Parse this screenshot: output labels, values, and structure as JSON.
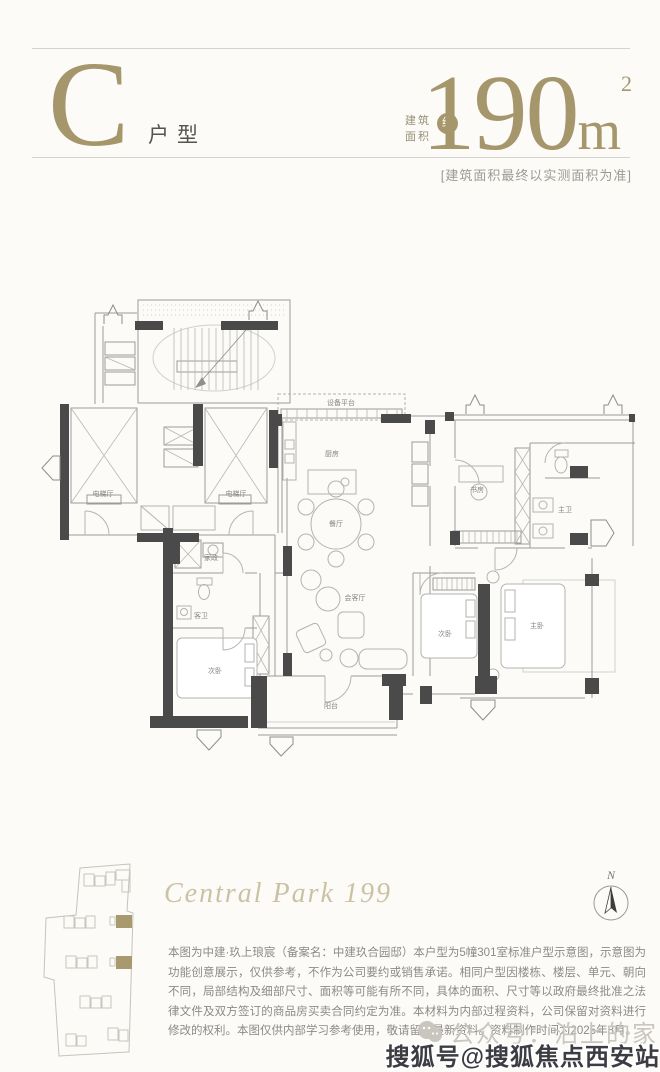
{
  "colors": {
    "accent": "#a5976b",
    "wall": "#4a4a4a",
    "text_gray": "#8b8b86"
  },
  "header": {
    "unit_letter": "C",
    "unit_type_label": "户型",
    "area_label_top": "建筑",
    "area_label_bottom": "面积",
    "area_approx": "约",
    "area_value": "190",
    "area_unit": "m",
    "area_unit_sup": "2",
    "area_note": "[建筑面积最终以实测面积为准]"
  },
  "floorplan": {
    "rooms": [
      {
        "label": "电梯厅",
        "x": 78,
        "y": 268
      },
      {
        "label": "电梯厅",
        "x": 211,
        "y": 268
      },
      {
        "label": "设备平台",
        "x": 316,
        "y": 177,
        "size": 5.5
      },
      {
        "label": "厨房",
        "x": 307,
        "y": 228
      },
      {
        "label": "餐厅",
        "x": 311,
        "y": 298
      },
      {
        "label": "会客厅",
        "x": 330,
        "y": 372
      },
      {
        "label": "书房",
        "x": 452,
        "y": 264
      },
      {
        "label": "主卫",
        "x": 540,
        "y": 284
      },
      {
        "label": "家政",
        "x": 186,
        "y": 332,
        "size": 5.5
      },
      {
        "label": "客卫",
        "x": 176,
        "y": 390,
        "size": 6
      },
      {
        "label": "次卧",
        "x": 190,
        "y": 445
      },
      {
        "label": "阳台",
        "x": 306,
        "y": 480
      },
      {
        "label": "次卧",
        "x": 420,
        "y": 408
      },
      {
        "label": "主卧",
        "x": 512,
        "y": 400
      }
    ]
  },
  "footer": {
    "project_script": "Central Park 199",
    "compass_label": "N",
    "disclaimer": "本图为中建·玖上琅宸（备案名：中建玖合园邸）本户型为5幢301室标准户型示意图，示意图为功能创意展示，仅供参考，不作为公司要约或销售承诺。相同户型因楼栋、楼层、单元、朝向不同，局部结构及细部尺寸、面积等可能有所不同，具体的面积、尺寸等以政府最终批准之法律文件及双方签订的商品房买卖合同约定为准。本材料为内部过程资料，公司保留对资料进行修改的权利。本图仅供内部学习参考使用，敬请留意最新资料。资料制作时间为2025年8月。"
  },
  "watermarks": {
    "wechat_account": "公众号：泊上的家",
    "sohu_account": "搜狐号@搜狐焦点西安站"
  }
}
